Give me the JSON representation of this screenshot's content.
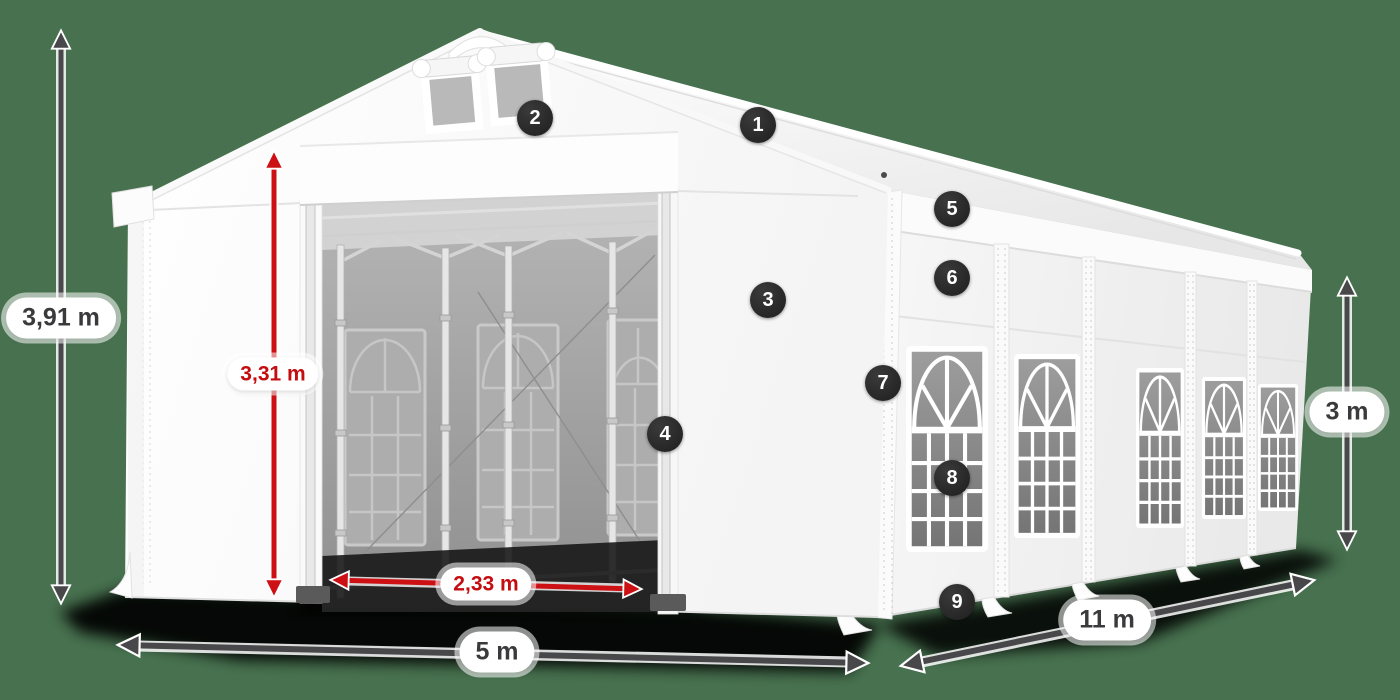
{
  "scene": {
    "background_color": "#47714F"
  },
  "palette": {
    "badge_background": "#242424",
    "badge_text": "#FFFFFF",
    "dimension_dark": "#48484A",
    "dimension_red": "#CC1014",
    "tent_white": "#FFFFFF"
  },
  "dimensions": [
    {
      "id": "total-height",
      "label": "3,91 m",
      "style": "dark"
    },
    {
      "id": "entrance-height",
      "label": "3,31 m",
      "style": "red"
    },
    {
      "id": "entrance-width",
      "label": "2,33 m",
      "style": "red"
    },
    {
      "id": "front-width",
      "label": "5 m",
      "style": "dark"
    },
    {
      "id": "side-length",
      "label": "11 m",
      "style": "dark"
    },
    {
      "id": "side-height",
      "label": "3 m",
      "style": "dark"
    }
  ],
  "callouts": [
    {
      "number": "1"
    },
    {
      "number": "2"
    },
    {
      "number": "3"
    },
    {
      "number": "4"
    },
    {
      "number": "5"
    },
    {
      "number": "6"
    },
    {
      "number": "7"
    },
    {
      "number": "8"
    },
    {
      "number": "9"
    }
  ]
}
